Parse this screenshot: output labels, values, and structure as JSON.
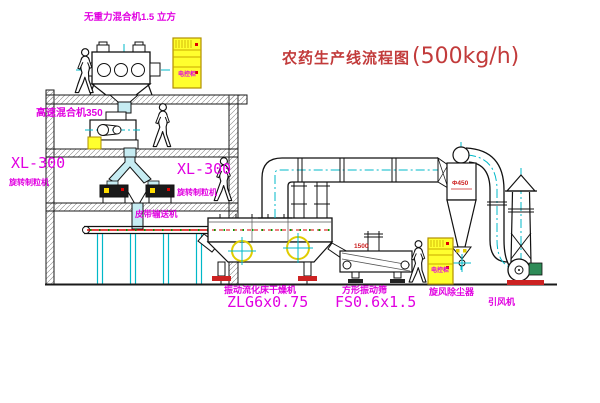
{
  "title": {
    "name": "农药生产线流程图",
    "capacity": "(500kg/h)"
  },
  "equipment_labels": {
    "gravity_mixer": "无重力混合机1.5 立方",
    "high_speed_mixer": "高速混合机350",
    "granulator_left_model": "XL-300",
    "granulator_left_name": "旋转制粒机",
    "granulator_right_model": "XL-300",
    "granulator_right_name": "旋转制粒机",
    "belt_conveyor": "皮带输送机",
    "dryer_name": "振动流化床干燥机",
    "dryer_model": "ZLG6x0.75",
    "sieve_name": "方形振动筛",
    "sieve_model": "FS0.6x1.5",
    "cyclone": "旋风除尘器",
    "fan": "引风机",
    "cabinet_1": "电控柜",
    "cabinet_2": "电控柜"
  },
  "dimensions": {
    "cyclone_dia": "Φ450",
    "sieve_dim": "1500"
  },
  "colors": {
    "label_magenta": "#e100e1",
    "title_red": "#c23b3b",
    "centerline_cyan": "#00b8c8",
    "cabinet_yellow": "#ffff2e",
    "belt_red": "#dd0000",
    "accent_red": "#cc2222",
    "dot_green": "#00a000",
    "motor_green": "#2e8b57",
    "chute_cyan": "#c6ecf2"
  }
}
